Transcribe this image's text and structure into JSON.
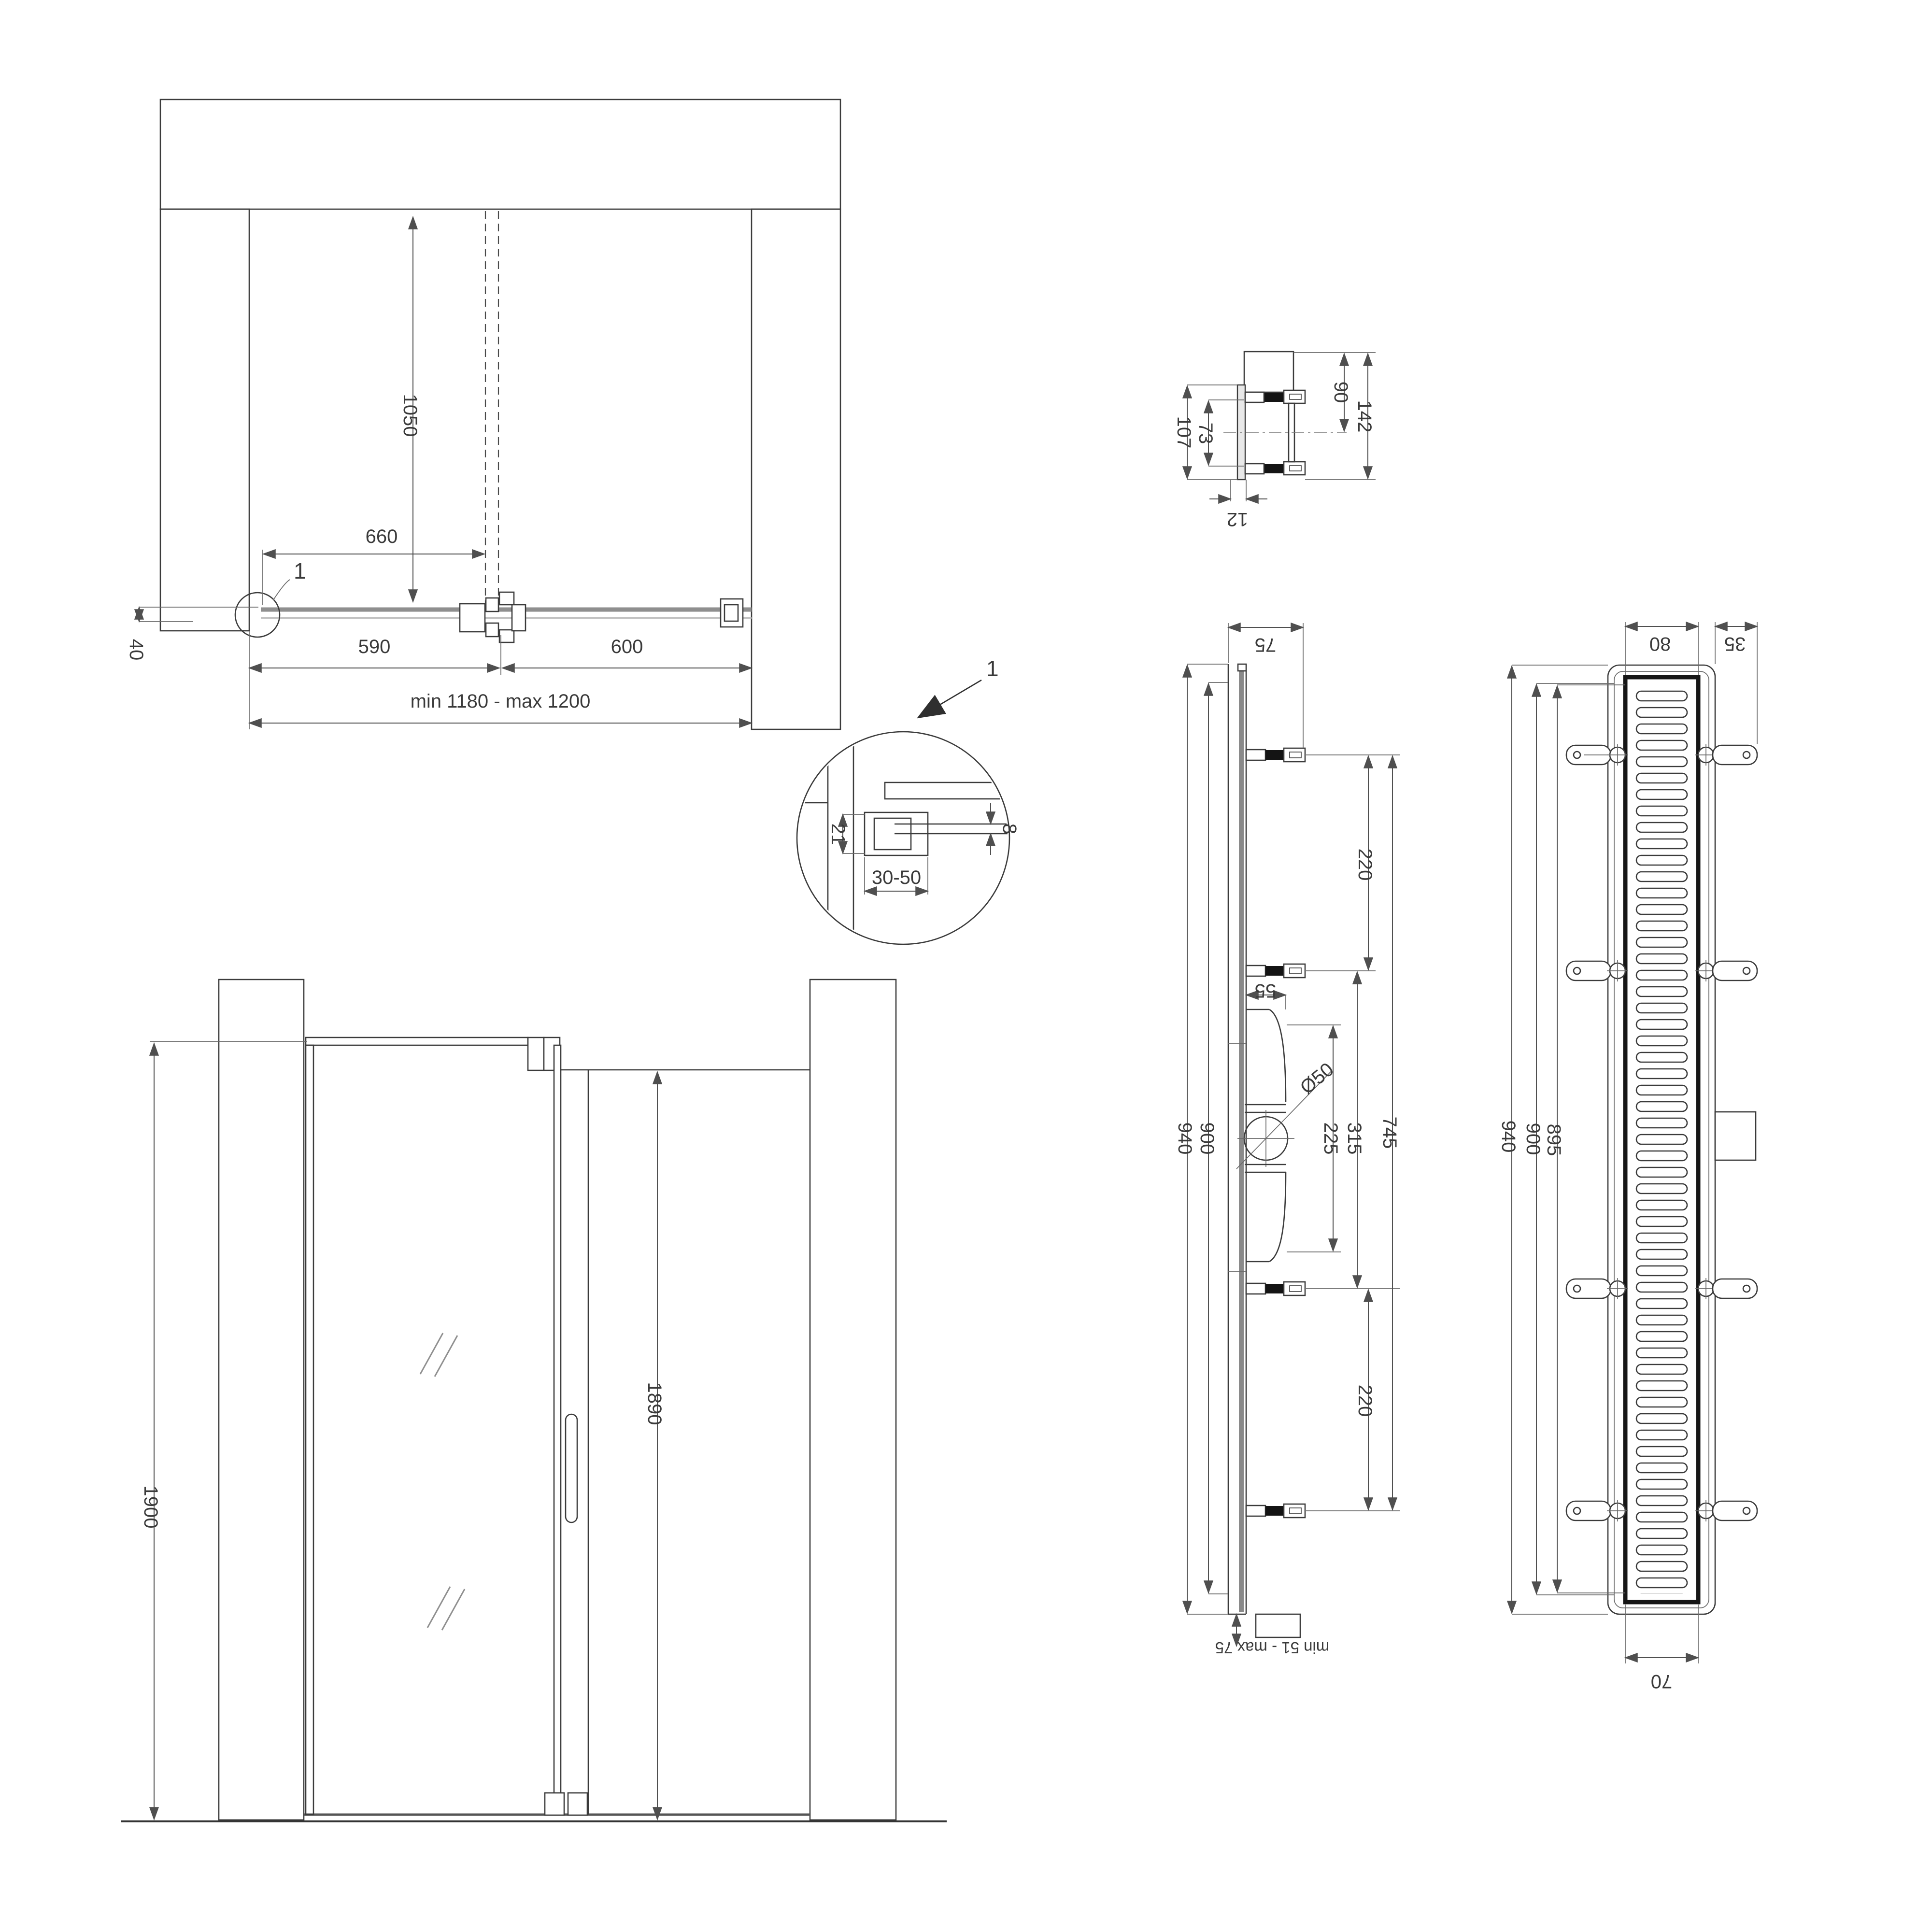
{
  "plan": {
    "ref": "1",
    "d1050": "1050",
    "d660": "660",
    "d590": "590",
    "d600": "600",
    "total": "min 1180 - max 1200",
    "d40": "40"
  },
  "front": {
    "d1900": "1900",
    "d1890": "1890"
  },
  "detail": {
    "callout": "1",
    "d21": "21",
    "d_range": "30-50",
    "d8": "8"
  },
  "bracket": {
    "d107": "107",
    "d73": "73",
    "d90": "90",
    "d142": "142",
    "d12": "12"
  },
  "side": {
    "d75": "75",
    "d940": "940",
    "d900": "900",
    "d220a": "220",
    "d55": "55",
    "dia": "Ø50",
    "d225": "225",
    "d315": "315",
    "d745": "745",
    "d220b": "220",
    "adjust": "min 51 - max 75"
  },
  "top": {
    "d80": "80",
    "d35": "35",
    "d940": "940",
    "d900": "900",
    "d895": "895",
    "d70": "70"
  },
  "colors": {
    "line": "#3b3b3b",
    "dim": "#4f4f4f",
    "glass": "#9b9b9b",
    "grate": "#161616",
    "text": "#3a3a3a"
  }
}
